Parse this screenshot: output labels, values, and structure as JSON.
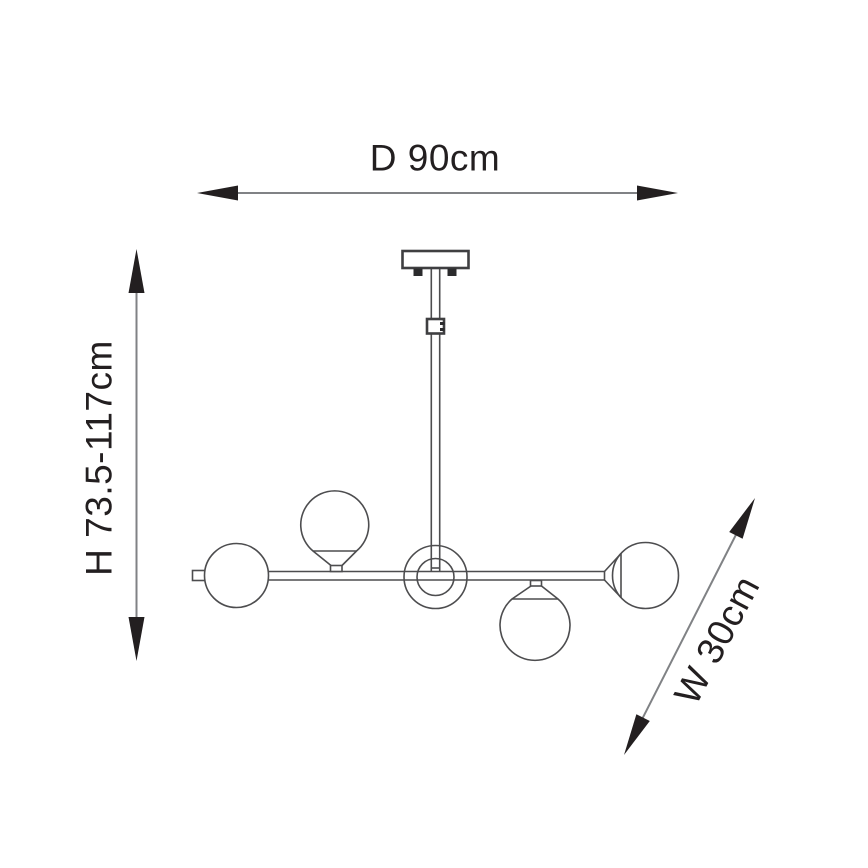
{
  "page": {
    "background_color": "#ffffff"
  },
  "dimensions": {
    "diameter": {
      "label": "D 90cm"
    },
    "height": {
      "label": "H 73.5-117cm"
    },
    "width": {
      "label": "W 30cm"
    }
  },
  "colors": {
    "dimension_line": "#808285",
    "arrowhead": "#231f20",
    "label_text": "#231f20",
    "drawing_line": "#4d4d4f"
  }
}
